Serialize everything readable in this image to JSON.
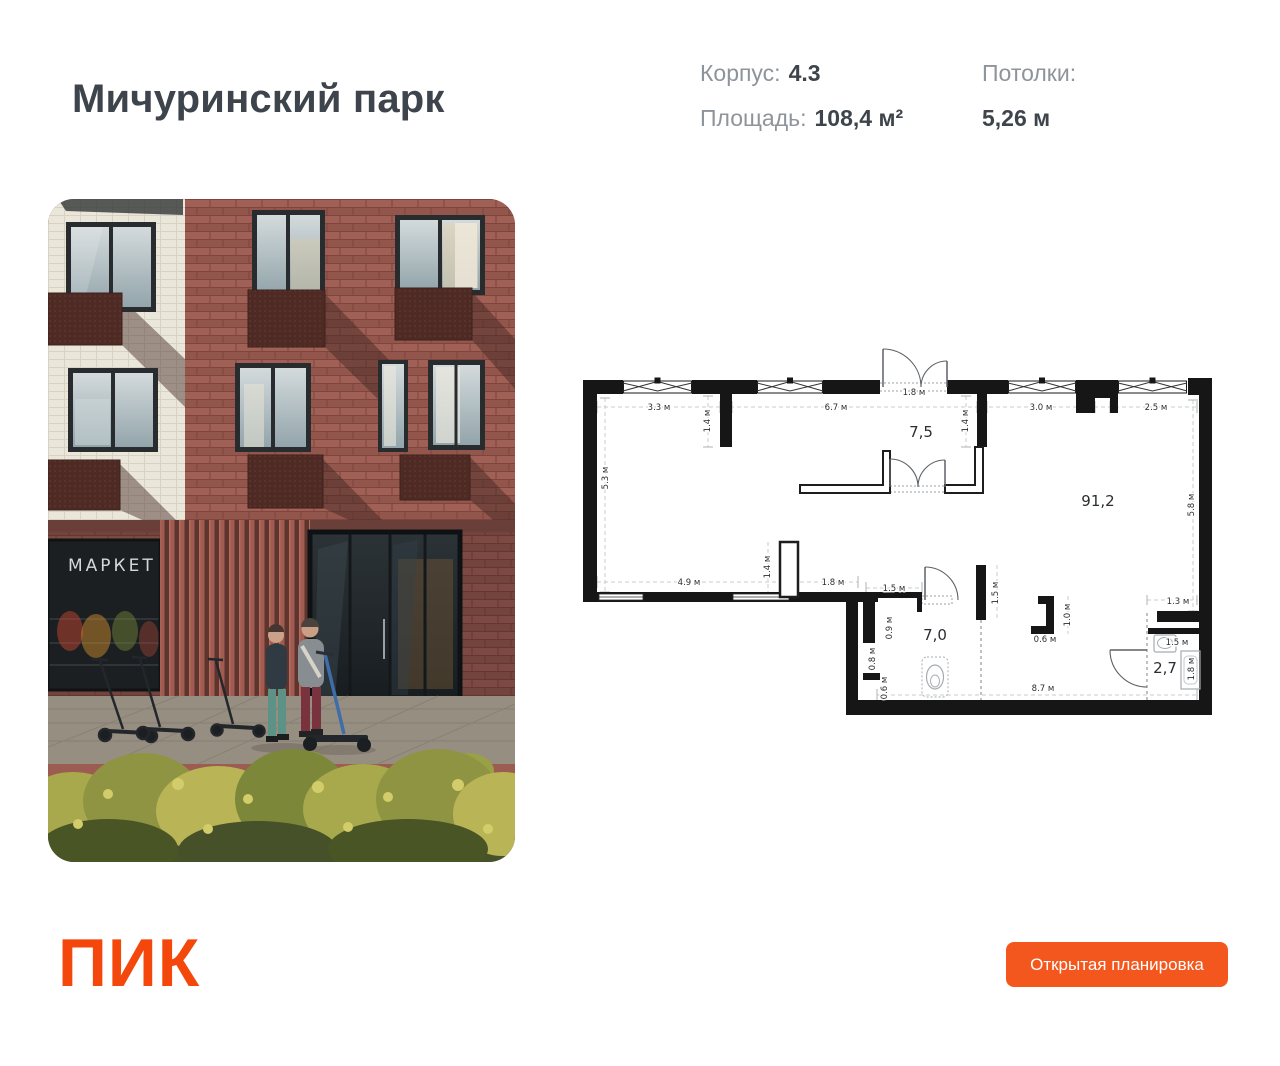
{
  "page": {
    "background": "#ffffff"
  },
  "header": {
    "title": "Мичуринский парк",
    "block_label": "Корпус:",
    "block_value": "4.3",
    "area_label": "Площадь:",
    "area_value": "108,4 м²",
    "ceilings_label": "Потолки:",
    "ceilings_value": "5,26 м"
  },
  "photo": {
    "market_sign": "МАРКЕТ"
  },
  "floorplan": {
    "total_area": "108,4",
    "rooms": [
      {
        "t": "7,5",
        "x": 921,
        "y": 437
      },
      {
        "t": "91,2",
        "x": 1098,
        "y": 506
      },
      {
        "t": "7,0",
        "x": 935,
        "y": 640
      },
      {
        "t": "2,7",
        "x": 1165,
        "y": 673
      }
    ],
    "dimensions": [
      {
        "t": "3.3 м",
        "x": 659,
        "y": 410
      },
      {
        "t": "6.7 м",
        "x": 836,
        "y": 410
      },
      {
        "t": "1.8 м",
        "x": 914,
        "y": 395
      },
      {
        "t": "3.0 м",
        "x": 1041,
        "y": 410
      },
      {
        "t": "2.5 м",
        "x": 1156,
        "y": 410
      },
      {
        "t": "5.3 м",
        "x": 608,
        "y": 478,
        "r": 1
      },
      {
        "t": "1.4 м",
        "x": 710,
        "y": 421,
        "r": 1
      },
      {
        "t": "1.4 м",
        "x": 968,
        "y": 421,
        "r": 1
      },
      {
        "t": "5.8 м",
        "x": 1194,
        "y": 505,
        "r": 1
      },
      {
        "t": "4.9 м",
        "x": 689,
        "y": 585
      },
      {
        "t": "1.4 м",
        "x": 770,
        "y": 567,
        "r": 1
      },
      {
        "t": "1.8 м",
        "x": 833,
        "y": 585
      },
      {
        "t": "1.5 м",
        "x": 894,
        "y": 591
      },
      {
        "t": "0.9 м",
        "x": 892,
        "y": 628,
        "r": 1
      },
      {
        "t": "0.8 м",
        "x": 875,
        "y": 659,
        "r": 1
      },
      {
        "t": "0.6 м",
        "x": 887,
        "y": 688,
        "r": 1
      },
      {
        "t": "1.5 м",
        "x": 998,
        "y": 593,
        "r": 1
      },
      {
        "t": "0.6 м",
        "x": 1045,
        "y": 642
      },
      {
        "t": "1.0 м",
        "x": 1070,
        "y": 615,
        "r": 1
      },
      {
        "t": "1.3 м",
        "x": 1178,
        "y": 604
      },
      {
        "t": "1.5 м",
        "x": 1177,
        "y": 645
      },
      {
        "t": "1.8 м",
        "x": 1194,
        "y": 669,
        "r": 1
      },
      {
        "t": "8.7 м",
        "x": 1043,
        "y": 691
      }
    ]
  },
  "footer": {
    "logo_text": "ПИК",
    "button_label": "Открытая планировка"
  },
  "colors": {
    "brand_orange": "#F4470B",
    "button_orange": "#F4571D",
    "title_gray": "#3E444B",
    "label_gray": "#8E949B"
  }
}
